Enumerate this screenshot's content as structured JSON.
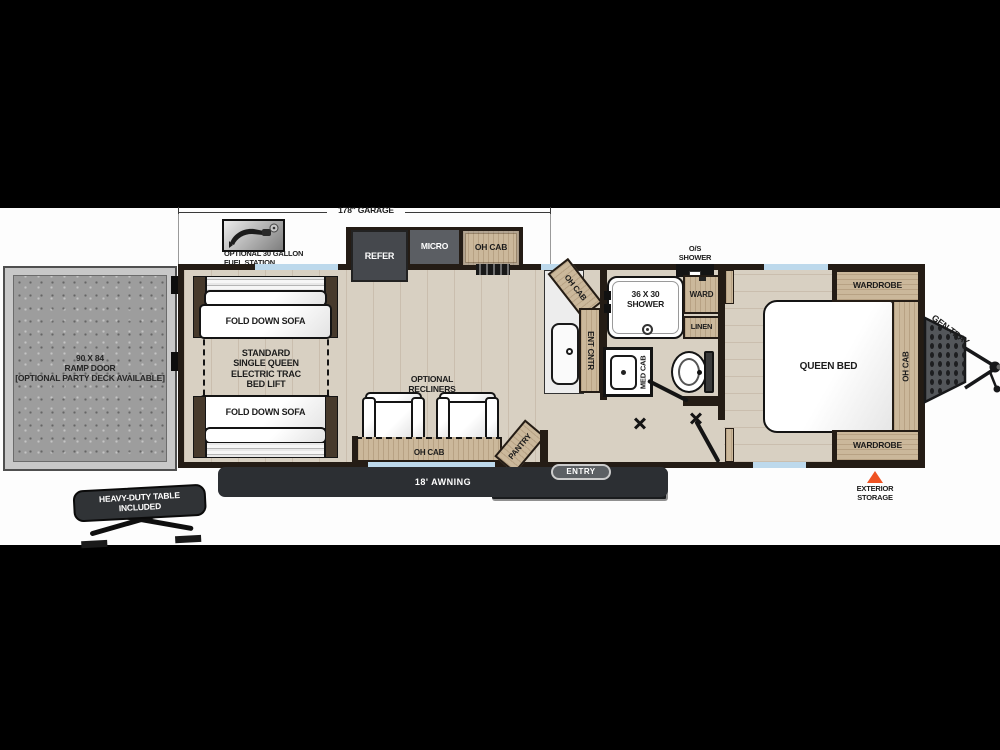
{
  "floorplan": {
    "garage_dim": "178\" GARAGE",
    "fuel_station": "OPTIONAL 30 GALLON\nFUEL STATION",
    "refer": "REFER",
    "micro": "MICRO",
    "oh_cab_kitchen": "OH CAB",
    "fold_down_sofa_top": "FOLD DOWN SOFA",
    "fold_down_sofa_bottom": "FOLD DOWN SOFA",
    "bed_lift": "STANDARD\nSINGLE QUEEN\nELECTRIC TRAC\nBED LIFT",
    "ramp_door": "90 X 84\nRAMP DOOR\n[OPTIONAL PARTY DECK AVAILABLE]",
    "optional_recliners": "OPTIONAL\nRECLINERS",
    "oh_cab_recliners": "OH CAB",
    "pantry": "PANTRY",
    "entry": "ENTRY",
    "awning": "18' AWNING",
    "table": "HEAVY-DUTY TABLE\nINCLUDED",
    "oh_cab_counter": "OH CAB",
    "ent_cntr": "ENT CNTR",
    "shower": "36 X 30\nSHOWER",
    "os_shower": "O/S\nSHOWER",
    "ward": "WARD",
    "linen": "LINEN",
    "med_cab": "MED CAB",
    "queen_bed": "QUEEN BED",
    "wardrobe_top": "WARDROBE",
    "wardrobe_bottom": "WARDROBE",
    "oh_cab_bedroom": "OH CAB",
    "gen_tray": "GEN TRAY",
    "exterior_storage": "EXTERIOR\nSTORAGE"
  },
  "colors": {
    "accent_orange": "#ef5222",
    "window_blue": "#bdd9ec",
    "cabinet_tan": "#cbb89b",
    "wood_floor": "#d8d0c2",
    "wall_dark": "#241c15"
  }
}
